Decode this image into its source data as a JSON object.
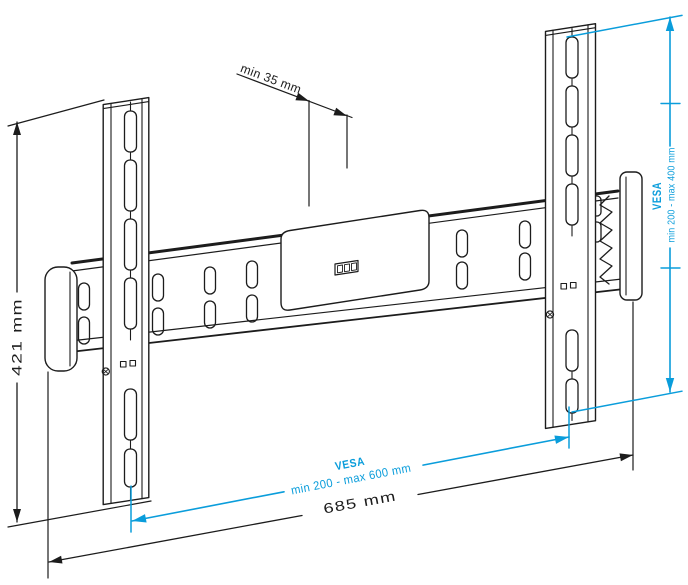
{
  "dimensions": {
    "depth": {
      "label": "min 35 mm"
    },
    "height": {
      "label": "421 mm"
    },
    "width": {
      "label": "685 mm"
    },
    "vesa_horizontal": {
      "title": "VESA",
      "range": "min 200 - max 600 mm"
    },
    "vesa_vertical": {
      "title": "VESA",
      "range": "min 200 - max 400 mm"
    }
  },
  "colors": {
    "dimension_blue": "#0a9ddb",
    "line_ink": "#1c1c1c",
    "background": "#ffffff"
  }
}
